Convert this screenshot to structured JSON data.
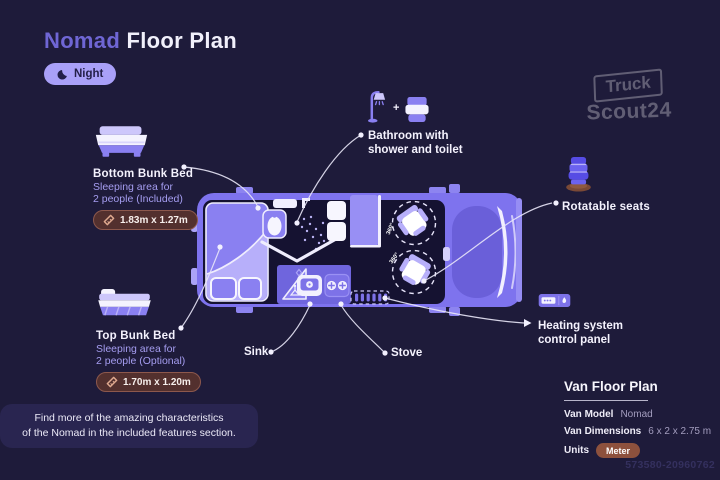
{
  "header": {
    "title_accent": "Nomad",
    "title_rest": " Floor Plan",
    "mode": {
      "label": "Night",
      "icon": "moon-icon"
    }
  },
  "watermark": {
    "line1": "Truck",
    "line2": "Scout24"
  },
  "callouts": {
    "bottom_bunk": {
      "title": "Bottom Bunk Bed",
      "desc_line1": "Sleeping area for",
      "desc_line2": "2 people (Included)",
      "dimensions": "1.83m x 1.27m"
    },
    "top_bunk": {
      "title": "Top Bunk Bed",
      "desc_line1": "Sleeping area for",
      "desc_line2": "2 people (Optional)",
      "dimensions": "1.70m x 1.20m"
    },
    "bathroom": {
      "line1": "Bathroom with",
      "line2": "shower and toilet"
    },
    "rotatable_seats": {
      "label": "Rotatable seats"
    },
    "heating": {
      "line1": "Heating system",
      "line2": "control panel"
    },
    "sink": {
      "label": "Sink"
    },
    "stove": {
      "label": "Stove"
    }
  },
  "floorplan": {
    "seat_rotation": "360°"
  },
  "footer_note": {
    "line1": "Find more of the amazing characteristics",
    "line2": "of the Nomad in the included features section."
  },
  "info_panel": {
    "title": "Van Floor Plan",
    "rows": [
      {
        "label": "Van Model",
        "value": "Nomad"
      },
      {
        "label": "Van Dimensions",
        "value": "6 x 2 x 2.75 m"
      },
      {
        "label": "Units",
        "value": "Meter"
      }
    ]
  },
  "image_id": "573580-20960762",
  "colors": {
    "background": "#1e1b3a",
    "van_body": "#7e73ee",
    "light_purple": "#a9a0f8",
    "badge_maroon": "#53302e",
    "units_badge": "#8d513d"
  }
}
